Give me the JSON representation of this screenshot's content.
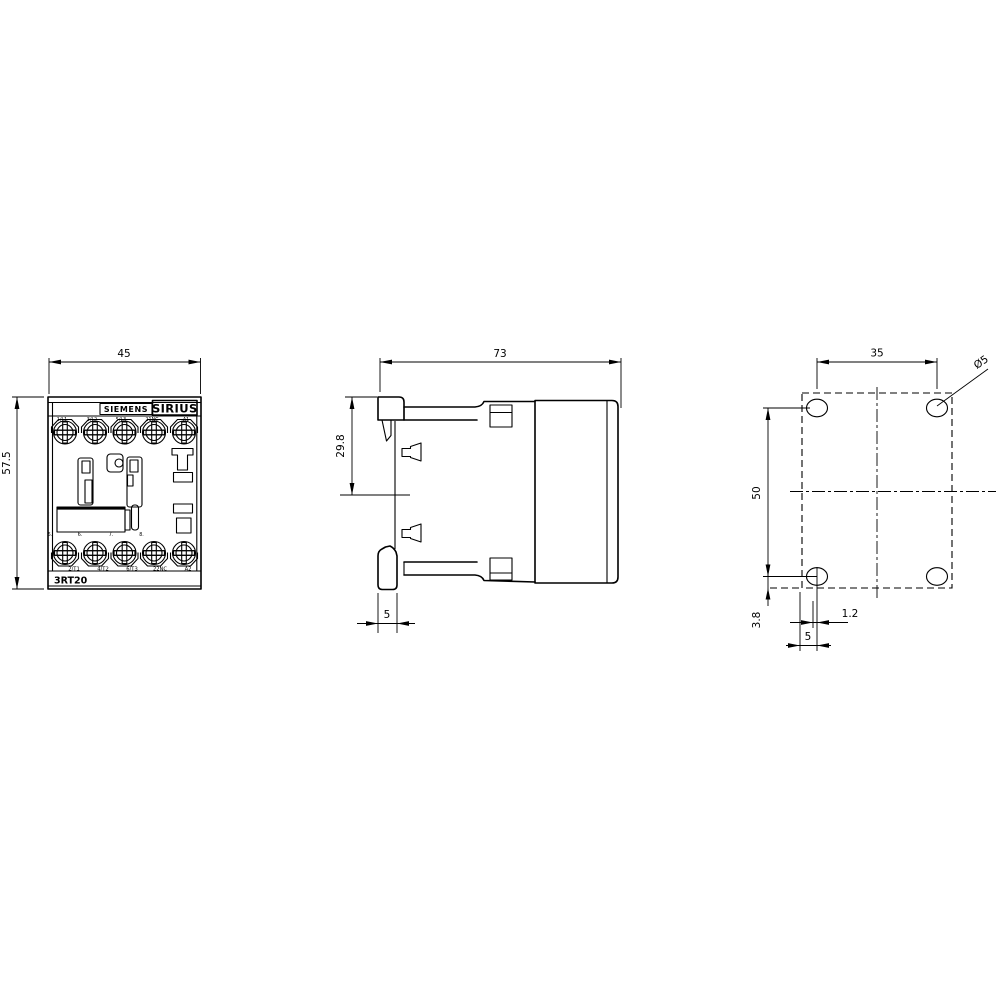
{
  "front": {
    "dim_width": "45",
    "dim_height": "57.5",
    "brand": "SIEMENS",
    "series": "SIRIUS",
    "model": "3RT20",
    "top_terminals": [
      "1/L1",
      "3/L2",
      "5/L3",
      "21NC",
      "A1"
    ],
    "pin_numbers": [
      "5.",
      "6.",
      "7.",
      "8."
    ],
    "bottom_terminals": [
      "2/T1",
      "4/T2",
      "6/T3",
      "22NC",
      "A2"
    ]
  },
  "side": {
    "dim_depth": "73",
    "dim_din_center": "29.8",
    "dim_rail": "5"
  },
  "mount": {
    "dim_hole_spacing_h": "35",
    "dim_hole_spacing_v": "50",
    "hole_diameter": "Ø5",
    "dim_edge": "3.8",
    "dim_offset": "1.2",
    "dim_bottom": "5"
  },
  "colors": {
    "line": "#000000",
    "background": "#ffffff"
  }
}
